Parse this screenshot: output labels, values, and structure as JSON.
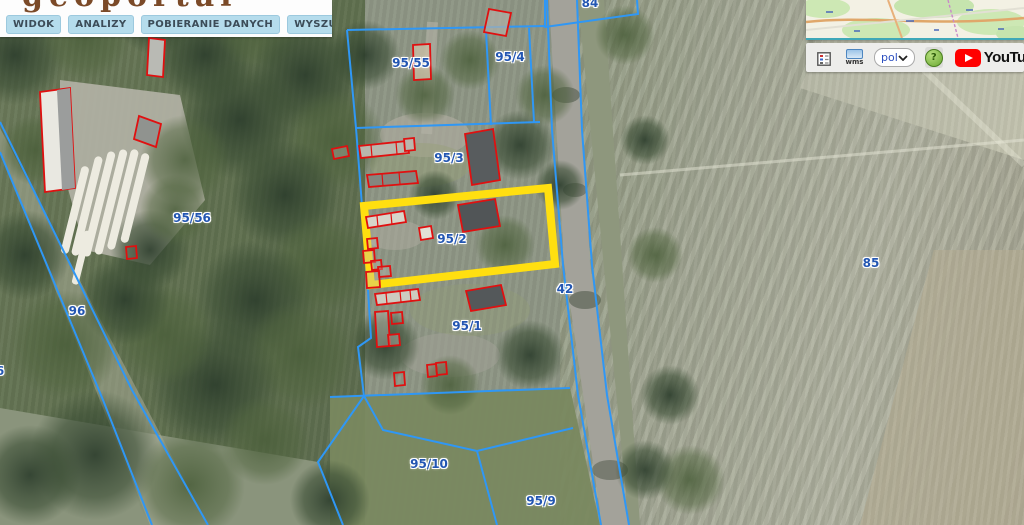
{
  "header": {
    "logo_text": "geoportal",
    "menu": [
      {
        "label": "WIDOK"
      },
      {
        "label": "ANALIZY"
      },
      {
        "label": "POBIERANIE DANYCH"
      },
      {
        "label": "WYSZUKIWANIA"
      }
    ]
  },
  "toolbar": {
    "wms_label": "wms",
    "language_value": "pol",
    "help_label": "?",
    "youtube_label": "YouTube"
  },
  "map": {
    "selected_parcel": "95/2",
    "parcel_labels": [
      {
        "text": "84",
        "x": 590,
        "y": 3
      },
      {
        "text": "95/55",
        "x": 411,
        "y": 63
      },
      {
        "text": "95/4",
        "x": 510,
        "y": 57
      },
      {
        "text": "95/3",
        "x": 449,
        "y": 158
      },
      {
        "text": "95/56",
        "x": 192,
        "y": 218
      },
      {
        "text": "95/2",
        "x": 452,
        "y": 239
      },
      {
        "text": "42",
        "x": 565,
        "y": 289
      },
      {
        "text": "96",
        "x": 77,
        "y": 311
      },
      {
        "text": "85",
        "x": 871,
        "y": 263
      },
      {
        "text": "95/1",
        "x": 467,
        "y": 326
      },
      {
        "text": "6",
        "x": 0,
        "y": 371
      },
      {
        "text": "95/10",
        "x": 429,
        "y": 464
      },
      {
        "text": "95/9",
        "x": 541,
        "y": 501
      }
    ],
    "colors": {
      "parcel_line": "#2f97f5",
      "building_outline": "#e01010",
      "selection_highlight": "#ffdf10",
      "label_text": "#2356b2",
      "menu_button_bg": "#b5dcec"
    }
  }
}
